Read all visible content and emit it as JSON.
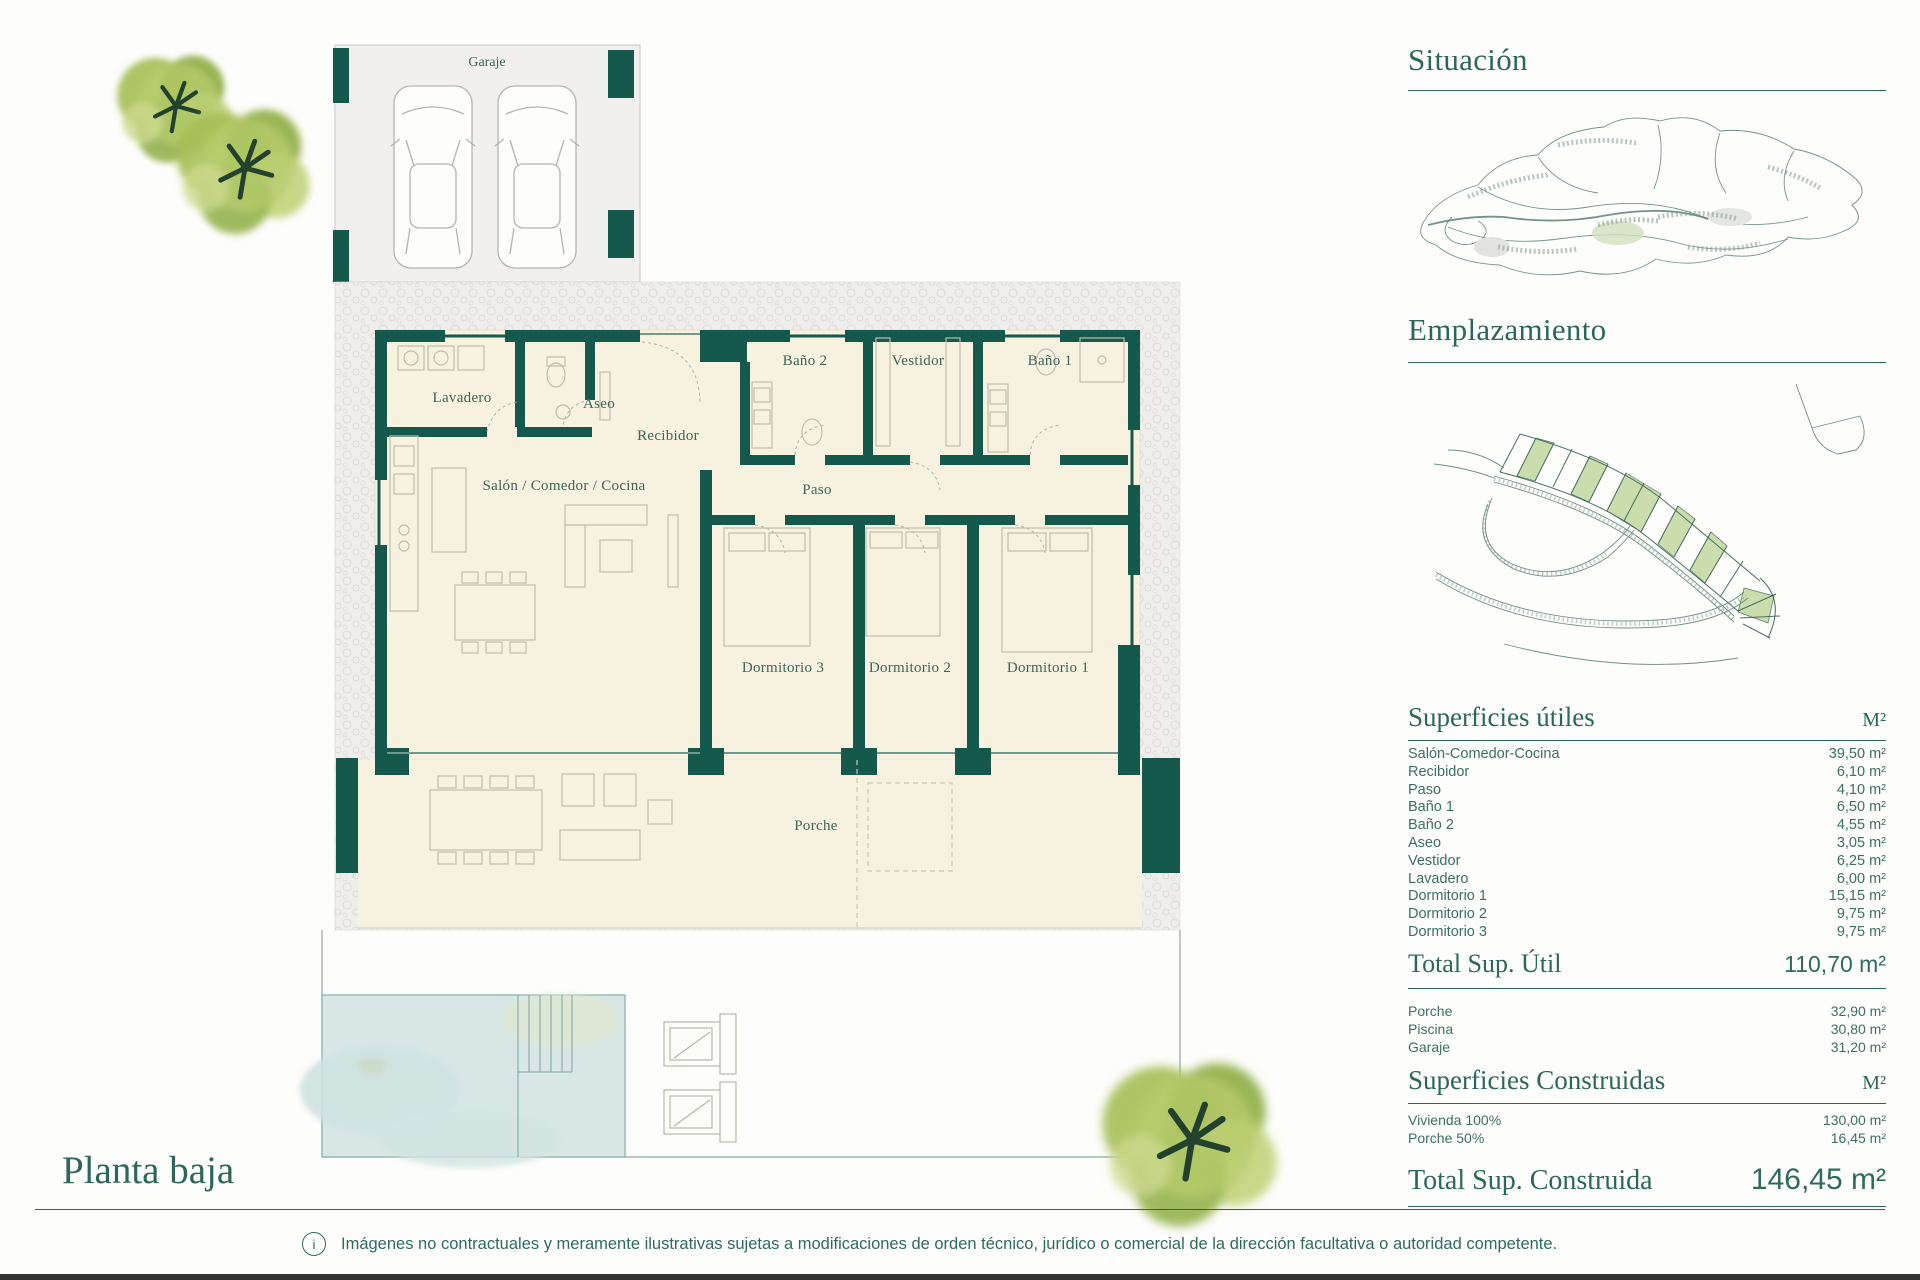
{
  "page": {
    "title": "Planta baja",
    "accent_color": "#1a5b4f",
    "floor_color": "#f7f2df",
    "pool_color": "#d8e7e6"
  },
  "footer": {
    "disclaimer": "Imágenes no contractuales y meramente ilustrativas sujetas a modificaciones de orden técnico, jurídico o comercial de la dirección facultativa o autoridad competente.",
    "info_glyph": "i"
  },
  "floorplan": {
    "garage_label": "Garaje",
    "rooms": {
      "lavadero": "Lavadero",
      "aseo": "Aseo",
      "recibidor": "Recibidor",
      "bano2": "Baño 2",
      "vestidor": "Vestidor",
      "bano1": "Baño 1",
      "salon": "Salón / Comedor / Cocina",
      "paso": "Paso",
      "dormitorio3": "Dormitorio 3",
      "dormitorio2": "Dormitorio 2",
      "dormitorio1": "Dormitorio 1",
      "porche": "Porche"
    }
  },
  "sidebar": {
    "situacion": {
      "title": "Situación"
    },
    "emplazamiento": {
      "title": "Emplazamiento"
    },
    "superficies_utiles": {
      "title": "Superficies útiles",
      "unit": "M²",
      "rows": [
        {
          "label": "Salón-Comedor-Cocina",
          "value": "39,50 m²"
        },
        {
          "label": "Recibidor",
          "value": "6,10 m²"
        },
        {
          "label": "Paso",
          "value": "4,10 m²"
        },
        {
          "label": "Baño 1",
          "value": "6,50 m²"
        },
        {
          "label": "Baño 2",
          "value": "4,55 m²"
        },
        {
          "label": "Aseo",
          "value": "3,05 m²"
        },
        {
          "label": "Vestidor",
          "value": "6,25 m²"
        },
        {
          "label": "Lavadero",
          "value": "6,00 m²"
        },
        {
          "label": "Dormitorio 1",
          "value": "15,15 m²"
        },
        {
          "label": "Dormitorio 2",
          "value": "9,75 m²"
        },
        {
          "label": "Dormitorio 3",
          "value": "9,75 m²"
        }
      ],
      "total_label": "Total Sup. Útil",
      "total_value": "110,70 m²"
    },
    "exterior_rows": [
      {
        "label": "Porche",
        "value": "32,90 m²"
      },
      {
        "label": "Piscina",
        "value": "30,80 m²"
      },
      {
        "label": "Garaje",
        "value": "31,20 m²"
      }
    ],
    "superficies_construidas": {
      "title": "Superficies Construidas",
      "unit": "M²",
      "rows": [
        {
          "label": "Vivienda 100%",
          "value": "130,00 m²"
        },
        {
          "label": "Porche 50%",
          "value": "16,45 m²"
        }
      ],
      "total_label": "Total Sup. Construida",
      "total_value": "146,45 m²"
    }
  }
}
